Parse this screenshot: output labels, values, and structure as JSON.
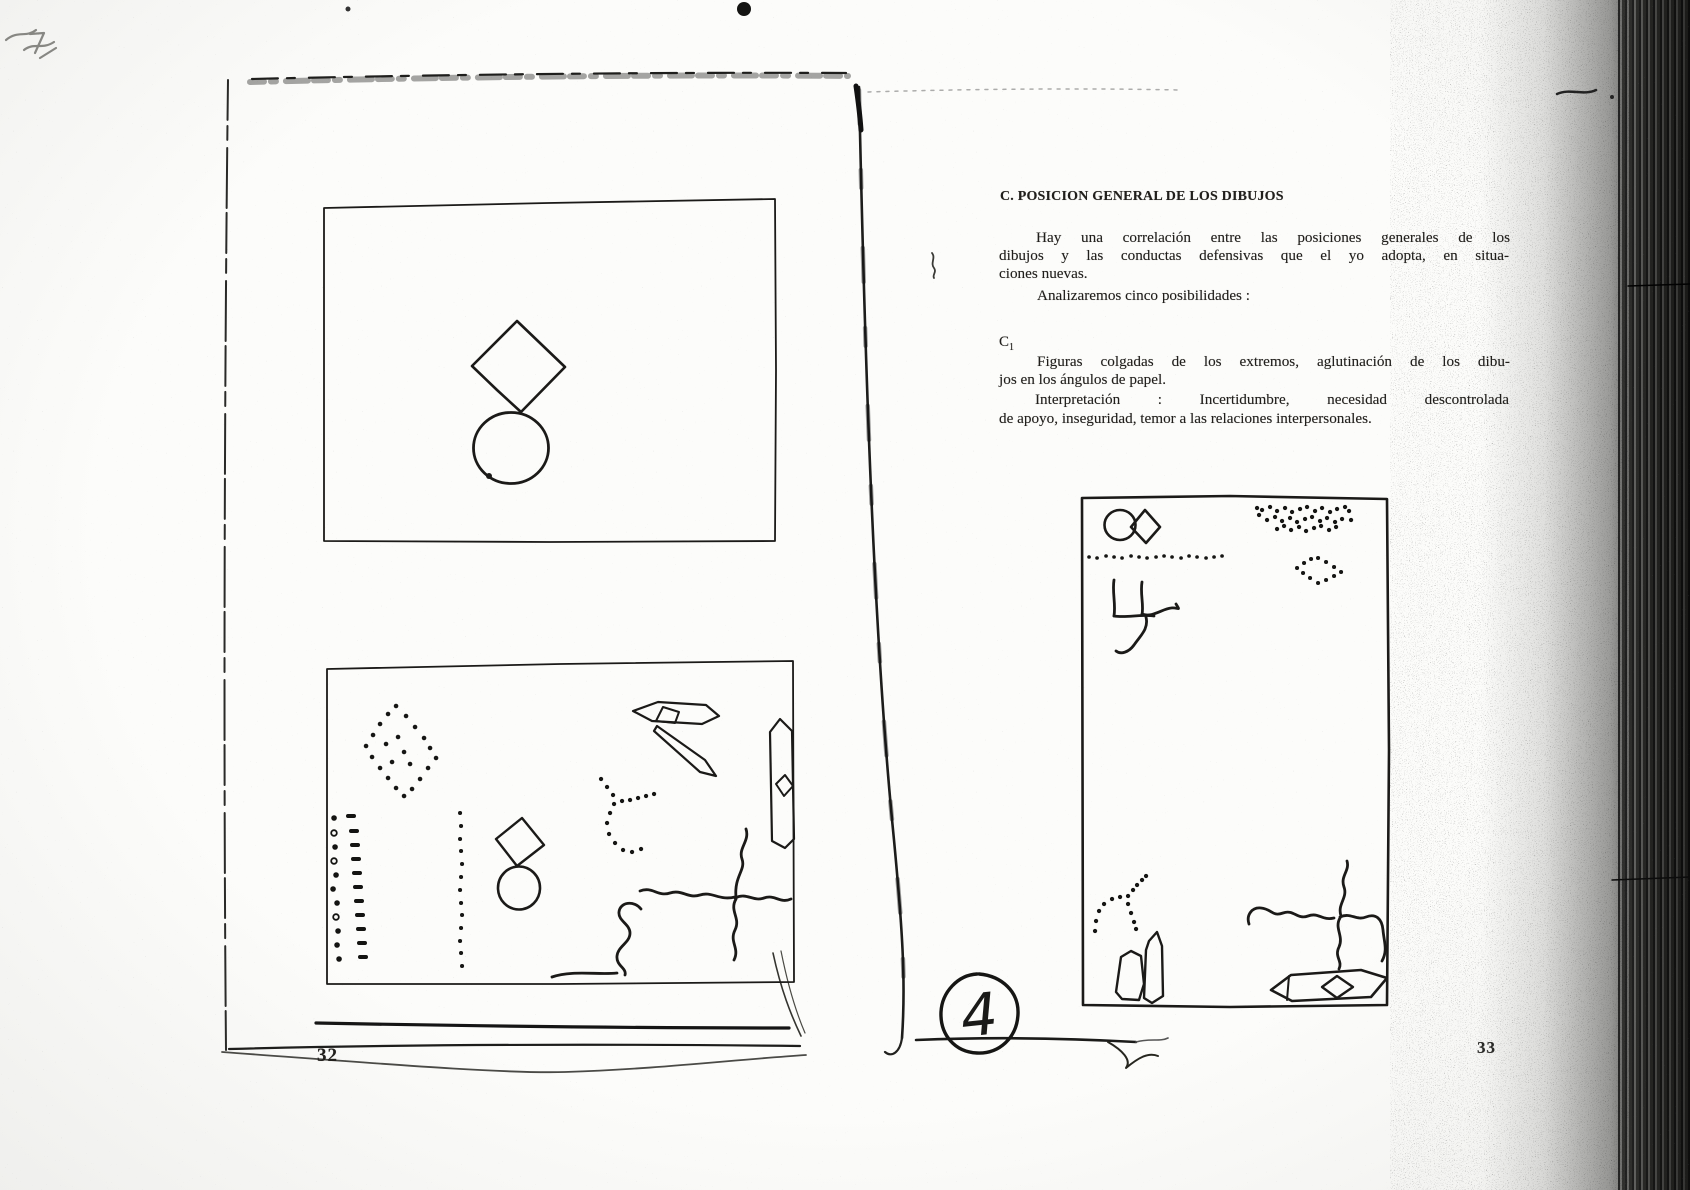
{
  "left_page": {
    "page_number": "32"
  },
  "right_page": {
    "page_number": "33",
    "heading": "C. POSICION GENERAL DE LOS DIBUJOS",
    "intro": {
      "line1": "Hay una correlación entre las posiciones generales de los",
      "line2": "dibujos y las conductas defensivas que el yo adopta, en situa-",
      "line3": "ciones nuevas.",
      "line4": "Analizaremos cinco posibilidades :"
    },
    "section": {
      "label_base": "C",
      "label_sub": "1",
      "line1": "Figuras colgadas de los extremos, aglutinación de los dibu-",
      "line2": "jos en los ángulos de papel.",
      "line3": "Interpretación : Incertidumbre, necesidad descontrolada",
      "line4": "de apoyo, inseguridad, temor a las relaciones interpersonales."
    },
    "handwritten_mark": "4"
  }
}
